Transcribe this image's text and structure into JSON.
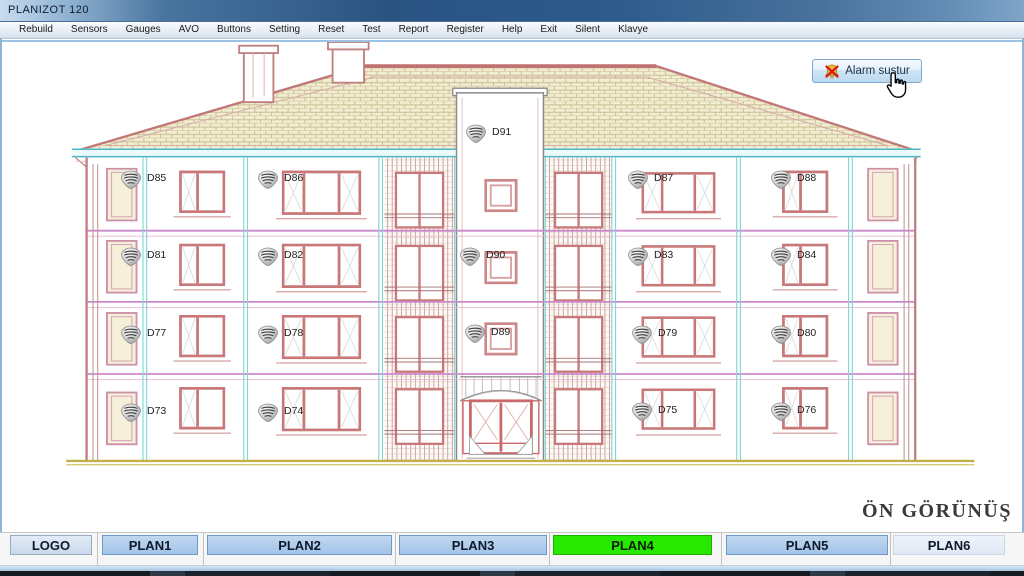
{
  "window": {
    "title": "PLANIZOT 120"
  },
  "menu": {
    "items": [
      "Rebuild",
      "Sensors",
      "Gauges",
      "AVO",
      "Buttons",
      "Setting",
      "Reset",
      "Test",
      "Report",
      "Register",
      "Help",
      "Exit",
      "Silent",
      "Klavye"
    ]
  },
  "toolbar": {
    "alarm_button_label": "Alarm sustur"
  },
  "drawing": {
    "caption": "ÖN GÖRÜNÜŞ",
    "detectors": [
      {
        "id": "D91",
        "x": 465,
        "y": 122
      },
      {
        "id": "D85",
        "x": 120,
        "y": 168
      },
      {
        "id": "D86",
        "x": 257,
        "y": 168
      },
      {
        "id": "D87",
        "x": 627,
        "y": 168
      },
      {
        "id": "D88",
        "x": 770,
        "y": 168
      },
      {
        "id": "D81",
        "x": 120,
        "y": 245
      },
      {
        "id": "D82",
        "x": 257,
        "y": 245
      },
      {
        "id": "D90",
        "x": 459,
        "y": 245
      },
      {
        "id": "D83",
        "x": 627,
        "y": 245
      },
      {
        "id": "D84",
        "x": 770,
        "y": 245
      },
      {
        "id": "D77",
        "x": 120,
        "y": 323
      },
      {
        "id": "D78",
        "x": 257,
        "y": 323
      },
      {
        "id": "D89",
        "x": 464,
        "y": 322
      },
      {
        "id": "D79",
        "x": 631,
        "y": 323
      },
      {
        "id": "D80",
        "x": 770,
        "y": 323
      },
      {
        "id": "D73",
        "x": 120,
        "y": 401
      },
      {
        "id": "D74",
        "x": 257,
        "y": 401
      },
      {
        "id": "D75",
        "x": 631,
        "y": 400
      },
      {
        "id": "D76",
        "x": 770,
        "y": 400
      }
    ]
  },
  "tabs": {
    "active": "PLAN4",
    "items": [
      {
        "label": "LOGO",
        "x": 10,
        "w": 82,
        "style": "logo"
      },
      {
        "label": "PLAN1",
        "x": 102,
        "w": 96,
        "style": "blue"
      },
      {
        "label": "PLAN2",
        "x": 207,
        "w": 185,
        "style": "blue"
      },
      {
        "label": "PLAN3",
        "x": 399,
        "w": 148,
        "style": "blue"
      },
      {
        "label": "PLAN4",
        "x": 553,
        "w": 159,
        "style": "green"
      },
      {
        "label": "PLAN5",
        "x": 726,
        "w": 162,
        "style": "blue"
      },
      {
        "label": "PLAN6",
        "x": 893,
        "w": 112,
        "style": "pale"
      }
    ],
    "divider_xs": [
      97,
      203,
      395,
      549,
      721,
      890
    ]
  },
  "colors": {
    "active_tab_green": "#26e800",
    "tab_blue": "#a2c4e8",
    "line_pink": "#c87878",
    "line_cyan": "#7fd4d4",
    "line_magenta": "#cc88cc",
    "ground_yellow": "#c8b850",
    "alarm_x_red": "#d81818"
  }
}
